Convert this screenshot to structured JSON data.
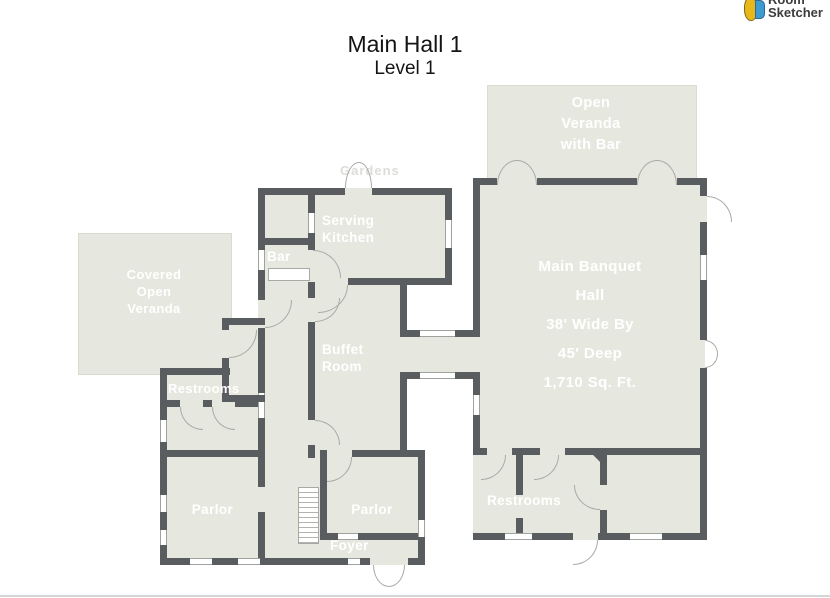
{
  "brand": {
    "name_top": "Room",
    "name_bottom": "Sketcher",
    "icon": "roomsketcher-3d-icon"
  },
  "title": {
    "main": "Main Hall 1",
    "level": "Level 1"
  },
  "exterior_faint_label": "Gardens",
  "rooms": {
    "open_veranda": "Open\nVeranda\nwith Bar",
    "main_banquet_hall": "Main Banquet\nHall\n38' Wide By\n45' Deep\n1,710 Sq. Ft.",
    "covered_veranda": "Covered\nOpen\nVeranda",
    "serving_kitchen": "Serving\nKitchen",
    "bar": "Bar",
    "buffet_room": "Buffet\nRoom",
    "restrooms_left": "Restrooms",
    "restrooms_right": "Restrooms",
    "parlor_left": "Parlor",
    "parlor_right": "Parlor",
    "foyer": "Foyer"
  },
  "colors": {
    "floor": "#e6e8df",
    "wall": "#595d5f",
    "room_label": "#ffffff",
    "title_text": "#141414"
  }
}
